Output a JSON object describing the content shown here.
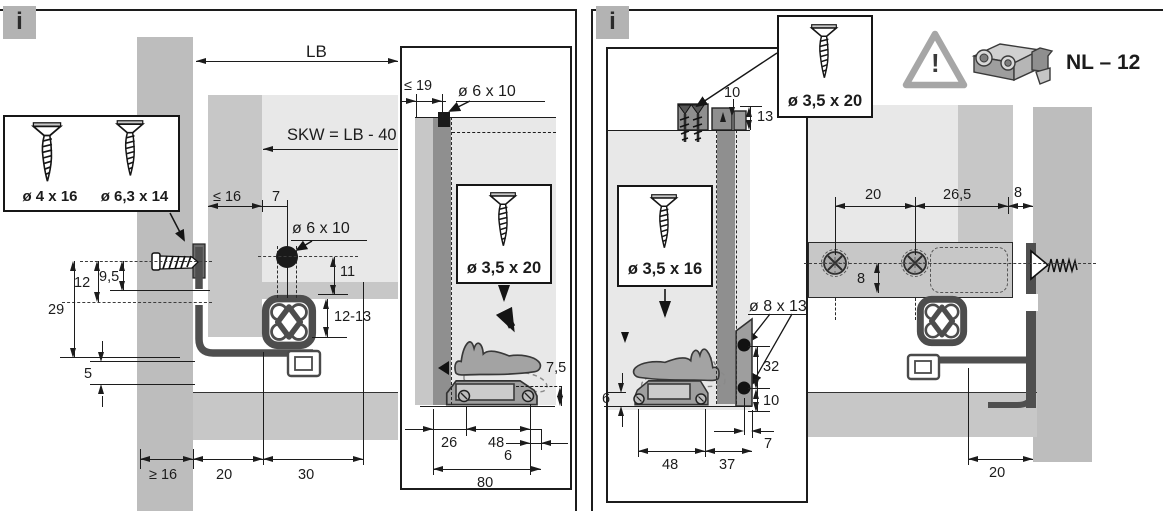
{
  "colors": {
    "line": "#1c1c1c",
    "wall_gray": "#bdbdbd",
    "surface_light": "#e8e8e8",
    "surface_mid": "#c7c7c7",
    "surface_dark": "#8f8f8f",
    "info_icon_bg": "#b3b3b3",
    "profile_dark": "#4f4f4f"
  },
  "left_panel": {
    "info_label": "i",
    "screw_box": {
      "screw_small": "ø 4 x 16",
      "screw_large": "ø 6,3 x 14"
    },
    "dims": {
      "lb": "LB",
      "skw": "SKW = LB - 40",
      "max16": "≤ 16",
      "d7": "7",
      "hole_front": "ø 6 x 10",
      "d11": "11",
      "d12_13": "12-13",
      "d12": "12",
      "d9_5": "9,5",
      "d29": "29",
      "d5": "5",
      "min16": "≥ 16",
      "d20": "20",
      "d30": "30"
    },
    "inset": {
      "max19": "≤ 19",
      "hole_rear": "ø 6 x 10",
      "screw_label": "ø 3,5 x 20",
      "d7_5": "7,5",
      "d26": "26",
      "d48": "48",
      "d6": "6",
      "d80": "80"
    }
  },
  "right_panel": {
    "info_label": "i",
    "screw_box_label": "ø 3,5 x 20",
    "warning_mark": "!",
    "part_code": "NL – 12",
    "rear_view": {
      "d10_top": "10",
      "d13": "13",
      "screw_label": "ø 3,5 x 16",
      "hole": "ø 8 x 13",
      "d32": "32",
      "d10_side": "10",
      "d6": "6",
      "d48": "48",
      "d37": "37",
      "d7": "7"
    },
    "top_view": {
      "d20": "20",
      "d26_5": "26,5",
      "d8_h": "8",
      "d8_v": "8",
      "d20_bottom": "20"
    }
  }
}
